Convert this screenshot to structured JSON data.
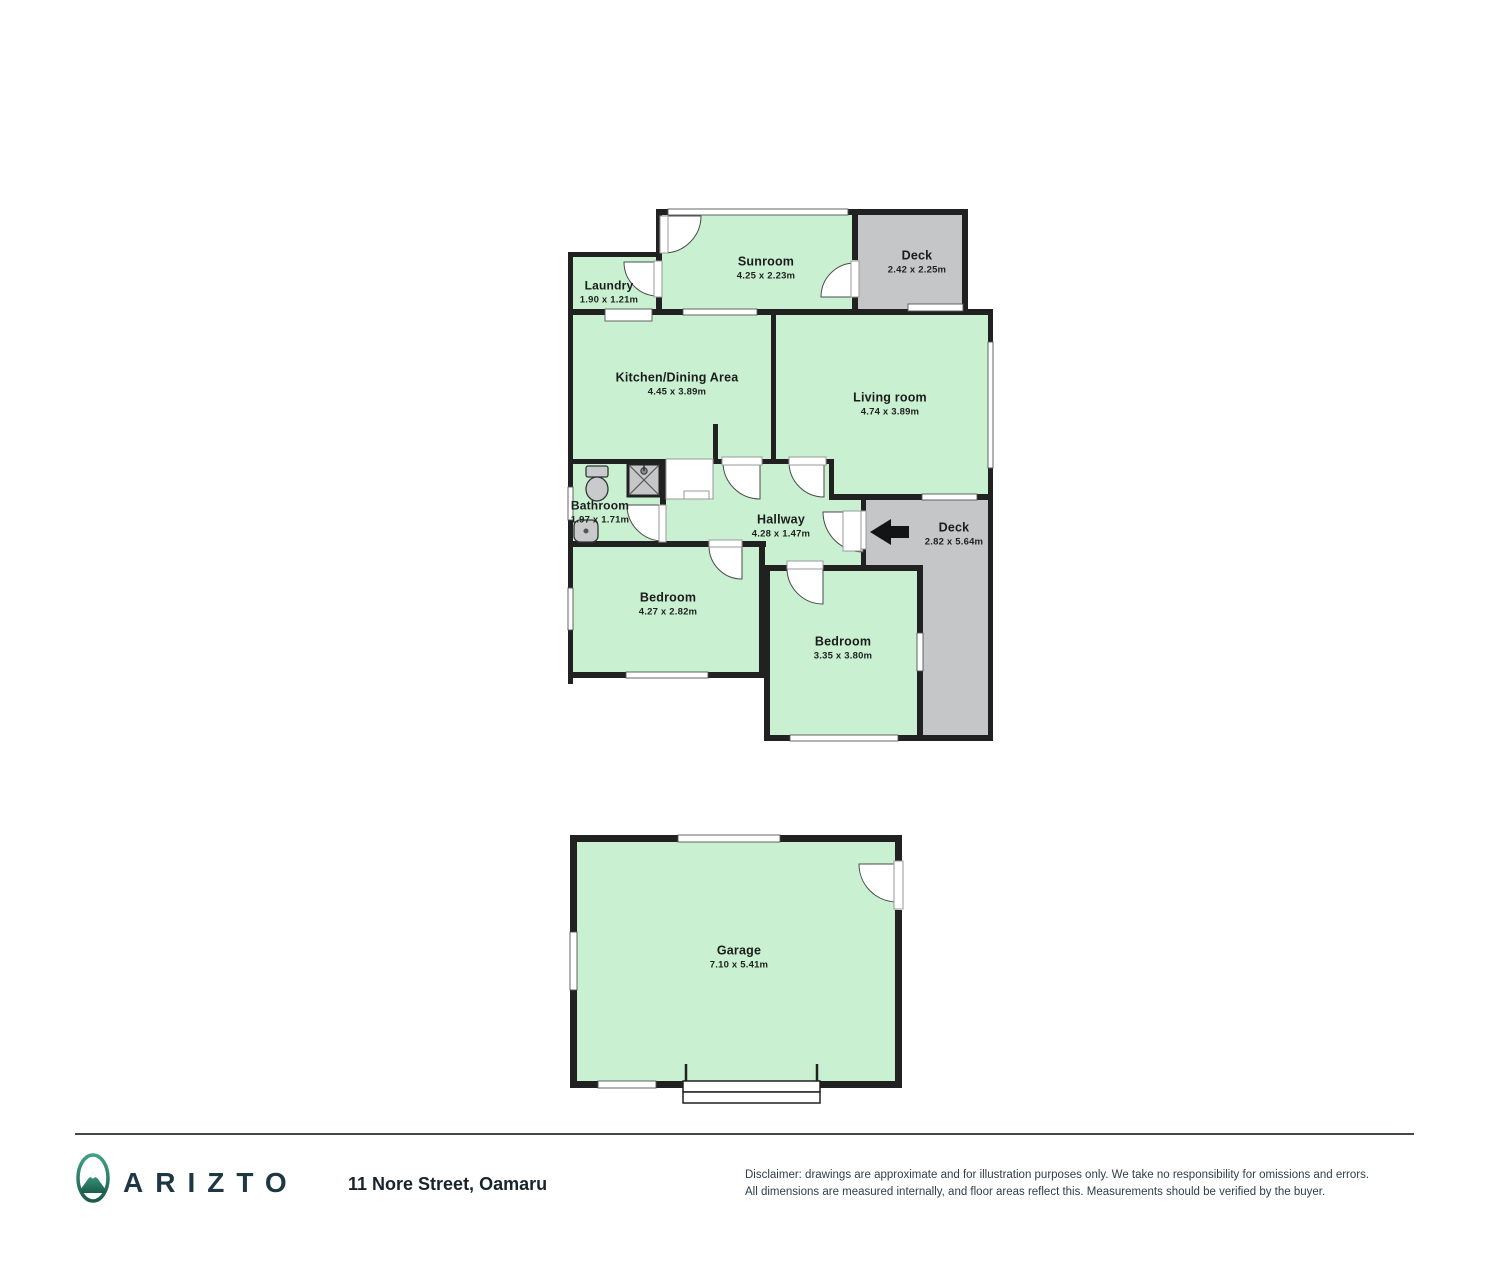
{
  "floorplan": {
    "rooms": [
      {
        "id": "sunroom",
        "name": "Sunroom",
        "dims": "4.25 x 2.23m"
      },
      {
        "id": "deck-top",
        "name": "Deck",
        "dims": "2.42 x 2.25m"
      },
      {
        "id": "laundry",
        "name": "Laundry",
        "dims": "1.90 x 1.21m"
      },
      {
        "id": "kitchen-dining",
        "name": "Kitchen/Dining Area",
        "dims": "4.45 x 3.89m"
      },
      {
        "id": "living-room",
        "name": "Living room",
        "dims": "4.74 x 3.89m"
      },
      {
        "id": "bathroom",
        "name": "Bathroom",
        "dims": "1.97 x 1.71m"
      },
      {
        "id": "hallway",
        "name": "Hallway",
        "dims": "4.28 x 1.47m"
      },
      {
        "id": "deck-side",
        "name": "Deck",
        "dims": "2.82 x 5.64m"
      },
      {
        "id": "bedroom-left",
        "name": "Bedroom",
        "dims": "4.27 x 2.82m"
      },
      {
        "id": "bedroom-right",
        "name": "Bedroom",
        "dims": "3.35 x 3.80m"
      },
      {
        "id": "garage",
        "name": "Garage",
        "dims": "7.10 x 5.41m"
      }
    ],
    "colors": {
      "room": "#c9f1d1",
      "deck": "#c5c6c8",
      "wall": "#212121"
    }
  },
  "footer": {
    "brand": "ARIZTO",
    "address": "11 Nore Street, Oamaru",
    "disclaimer_line1": "Disclaimer: drawings are approximate and for illustration purposes only. We take no responsibility for omissions and errors.",
    "disclaimer_line2": "All dimensions are measured internally, and floor areas reflect this. Measurements should be verified by the buyer."
  }
}
